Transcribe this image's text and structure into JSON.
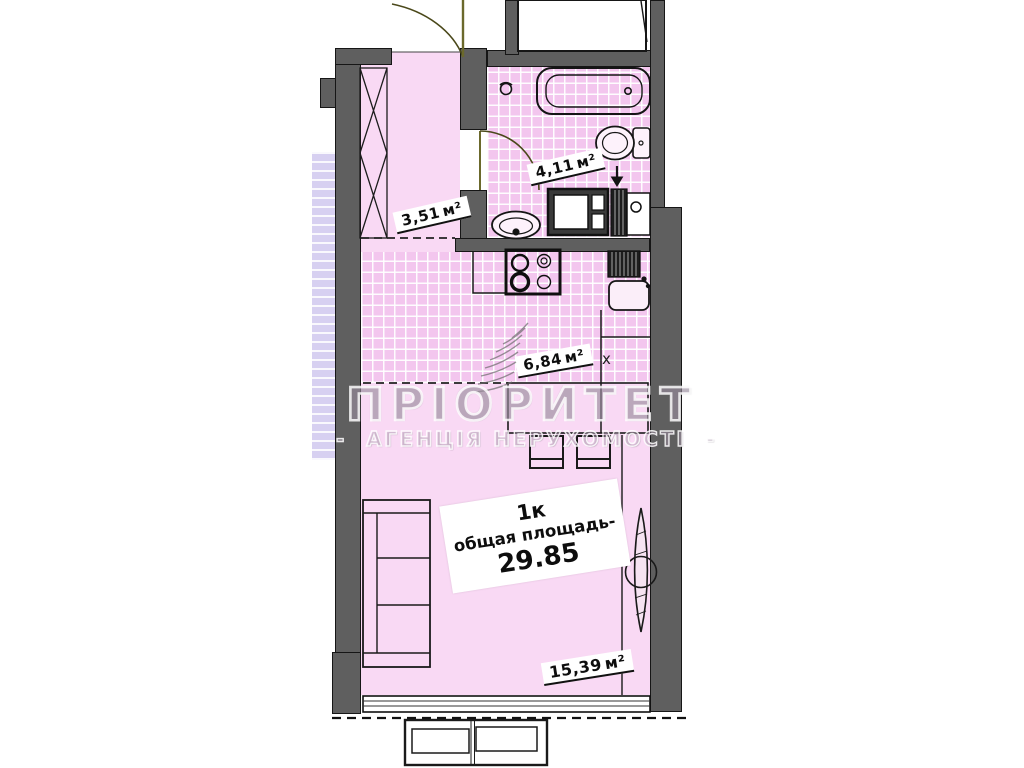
{
  "watermark": {
    "brand": "ПРІОРИТЕТ",
    "agency": "АГЕНЦІЯ НЕРУХОМОСТІ",
    "dash": "-"
  },
  "plan": {
    "unit_label": "1к",
    "total_area_label": "общая площадь-",
    "total_area_value": "29.85",
    "rooms": {
      "hallway": {
        "area": "3,51",
        "unit": "м²"
      },
      "bathroom": {
        "area": "4,11",
        "unit": "м²"
      },
      "kitchen": {
        "area": "6,84",
        "unit": "м²"
      },
      "living_room": {
        "area": "15,39",
        "unit": "м²"
      }
    },
    "markers": {
      "fridge": "x"
    }
  },
  "colors": {
    "room_pink": "#f9d9f4",
    "tile_pink": "#f3c6ee",
    "wall_gray": "#5f5f5f",
    "neighbor_lavender": "#d7d0f1",
    "door_olive": "#6b692c",
    "background": "#ffffff"
  }
}
